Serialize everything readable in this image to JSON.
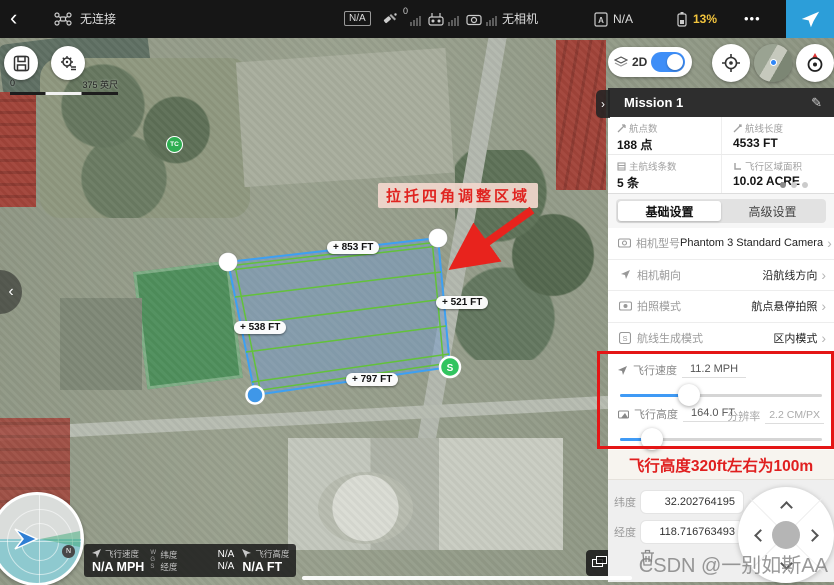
{
  "top_bar": {
    "back_icon": "‹",
    "connection_status": "无连接",
    "aircraft_na": "N/A",
    "gps_count": "0",
    "camera_status": "无相机",
    "checklist_na": "N/A",
    "battery_percent": "13%",
    "more_icon": "•••"
  },
  "map": {
    "scale_zero": "0",
    "scale_label": "375 英尺",
    "poi_label": "TC",
    "collapse_left_icon": "‹",
    "drag_hint": "拉托四角调整区域",
    "edge_labels": [
      "+ 853 FT",
      "+ 521 FT",
      "+ 538 FT",
      "+ 797 FT"
    ],
    "start_marker": "S",
    "compass_north": "N"
  },
  "panel": {
    "collapse_icon": "›",
    "mode_label": "2D",
    "title": "Mission 1",
    "edit_icon": "✎",
    "chevron_icon": "›",
    "stats": [
      {
        "label": "航点数",
        "value": "188 点"
      },
      {
        "label": "航线长度",
        "value": "4533 FT"
      },
      {
        "label": "主航线条数",
        "value": "5 条"
      },
      {
        "label": "飞行区域面积",
        "value": "10.02 ACRE"
      }
    ],
    "tabs": [
      {
        "label": "基础设置"
      },
      {
        "label": "高级设置"
      }
    ],
    "settings": [
      {
        "label": "相机型号",
        "value": "Phantom 3 Standard Camera"
      },
      {
        "label": "相机朝向",
        "value": "沿航线方向"
      },
      {
        "label": "拍照模式",
        "value": "航点悬停拍照"
      },
      {
        "label": "航线生成模式",
        "value": "区内模式"
      }
    ],
    "sliders": [
      {
        "label": "飞行速度",
        "value": "11.2 MPH",
        "percent": 34
      },
      {
        "label": "飞行高度",
        "value": "164.0 FT",
        "res_label": "分辨率",
        "res_value": "2.2 CM/PX",
        "percent": 16
      }
    ],
    "altitude_note": "飞行高度320ft左右为100m",
    "coords": [
      {
        "label": "纬度",
        "value": "32.202764195"
      },
      {
        "label": "经度",
        "value": "118.716763493"
      }
    ]
  },
  "telemetry": {
    "speed_label": "飞行速度",
    "speed_value": "N/A MPH",
    "wgs": "WGS",
    "lat_label": "纬度",
    "lat_value": "N/A",
    "lon_label": "经度",
    "lon_value": "N/A",
    "alt_label": "飞行高度",
    "alt_value": "N/A FT"
  },
  "watermark": "CSDN @一别如斯AA"
}
